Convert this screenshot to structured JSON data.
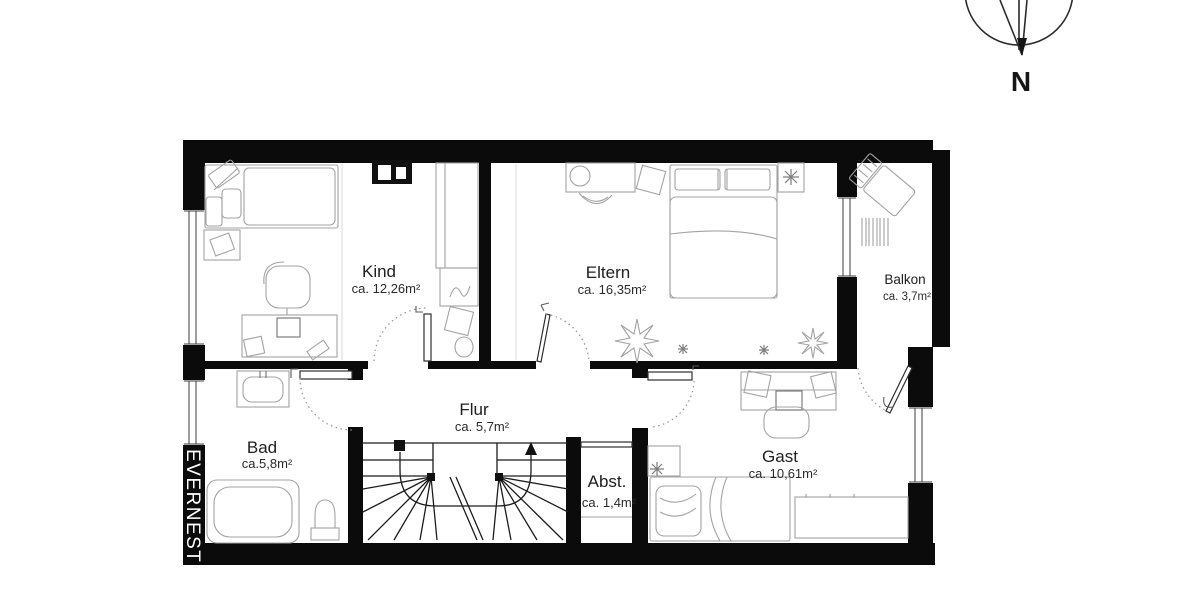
{
  "brand": {
    "name": "EVERNEST"
  },
  "compass": {
    "label": "N"
  },
  "rooms": {
    "kind": {
      "name": "Kind",
      "area": "ca. 12,26m²"
    },
    "eltern": {
      "name": "Eltern",
      "area": "ca. 16,35m²"
    },
    "balkon": {
      "name": "Balkon",
      "area": "ca. 3,7m²"
    },
    "flur": {
      "name": "Flur",
      "area": "ca. 5,7m²"
    },
    "bad": {
      "name": "Bad",
      "area": "ca.5,8m²"
    },
    "abstellraum": {
      "name": "Abst.",
      "area": "ca. 1,4m²"
    },
    "gast": {
      "name": "Gast",
      "area": "ca. 10,61m²"
    }
  },
  "colors": {
    "wall": "#0b0b0b",
    "furniture": "#a3a3a3",
    "label": "#202020",
    "background": "#ffffff"
  }
}
